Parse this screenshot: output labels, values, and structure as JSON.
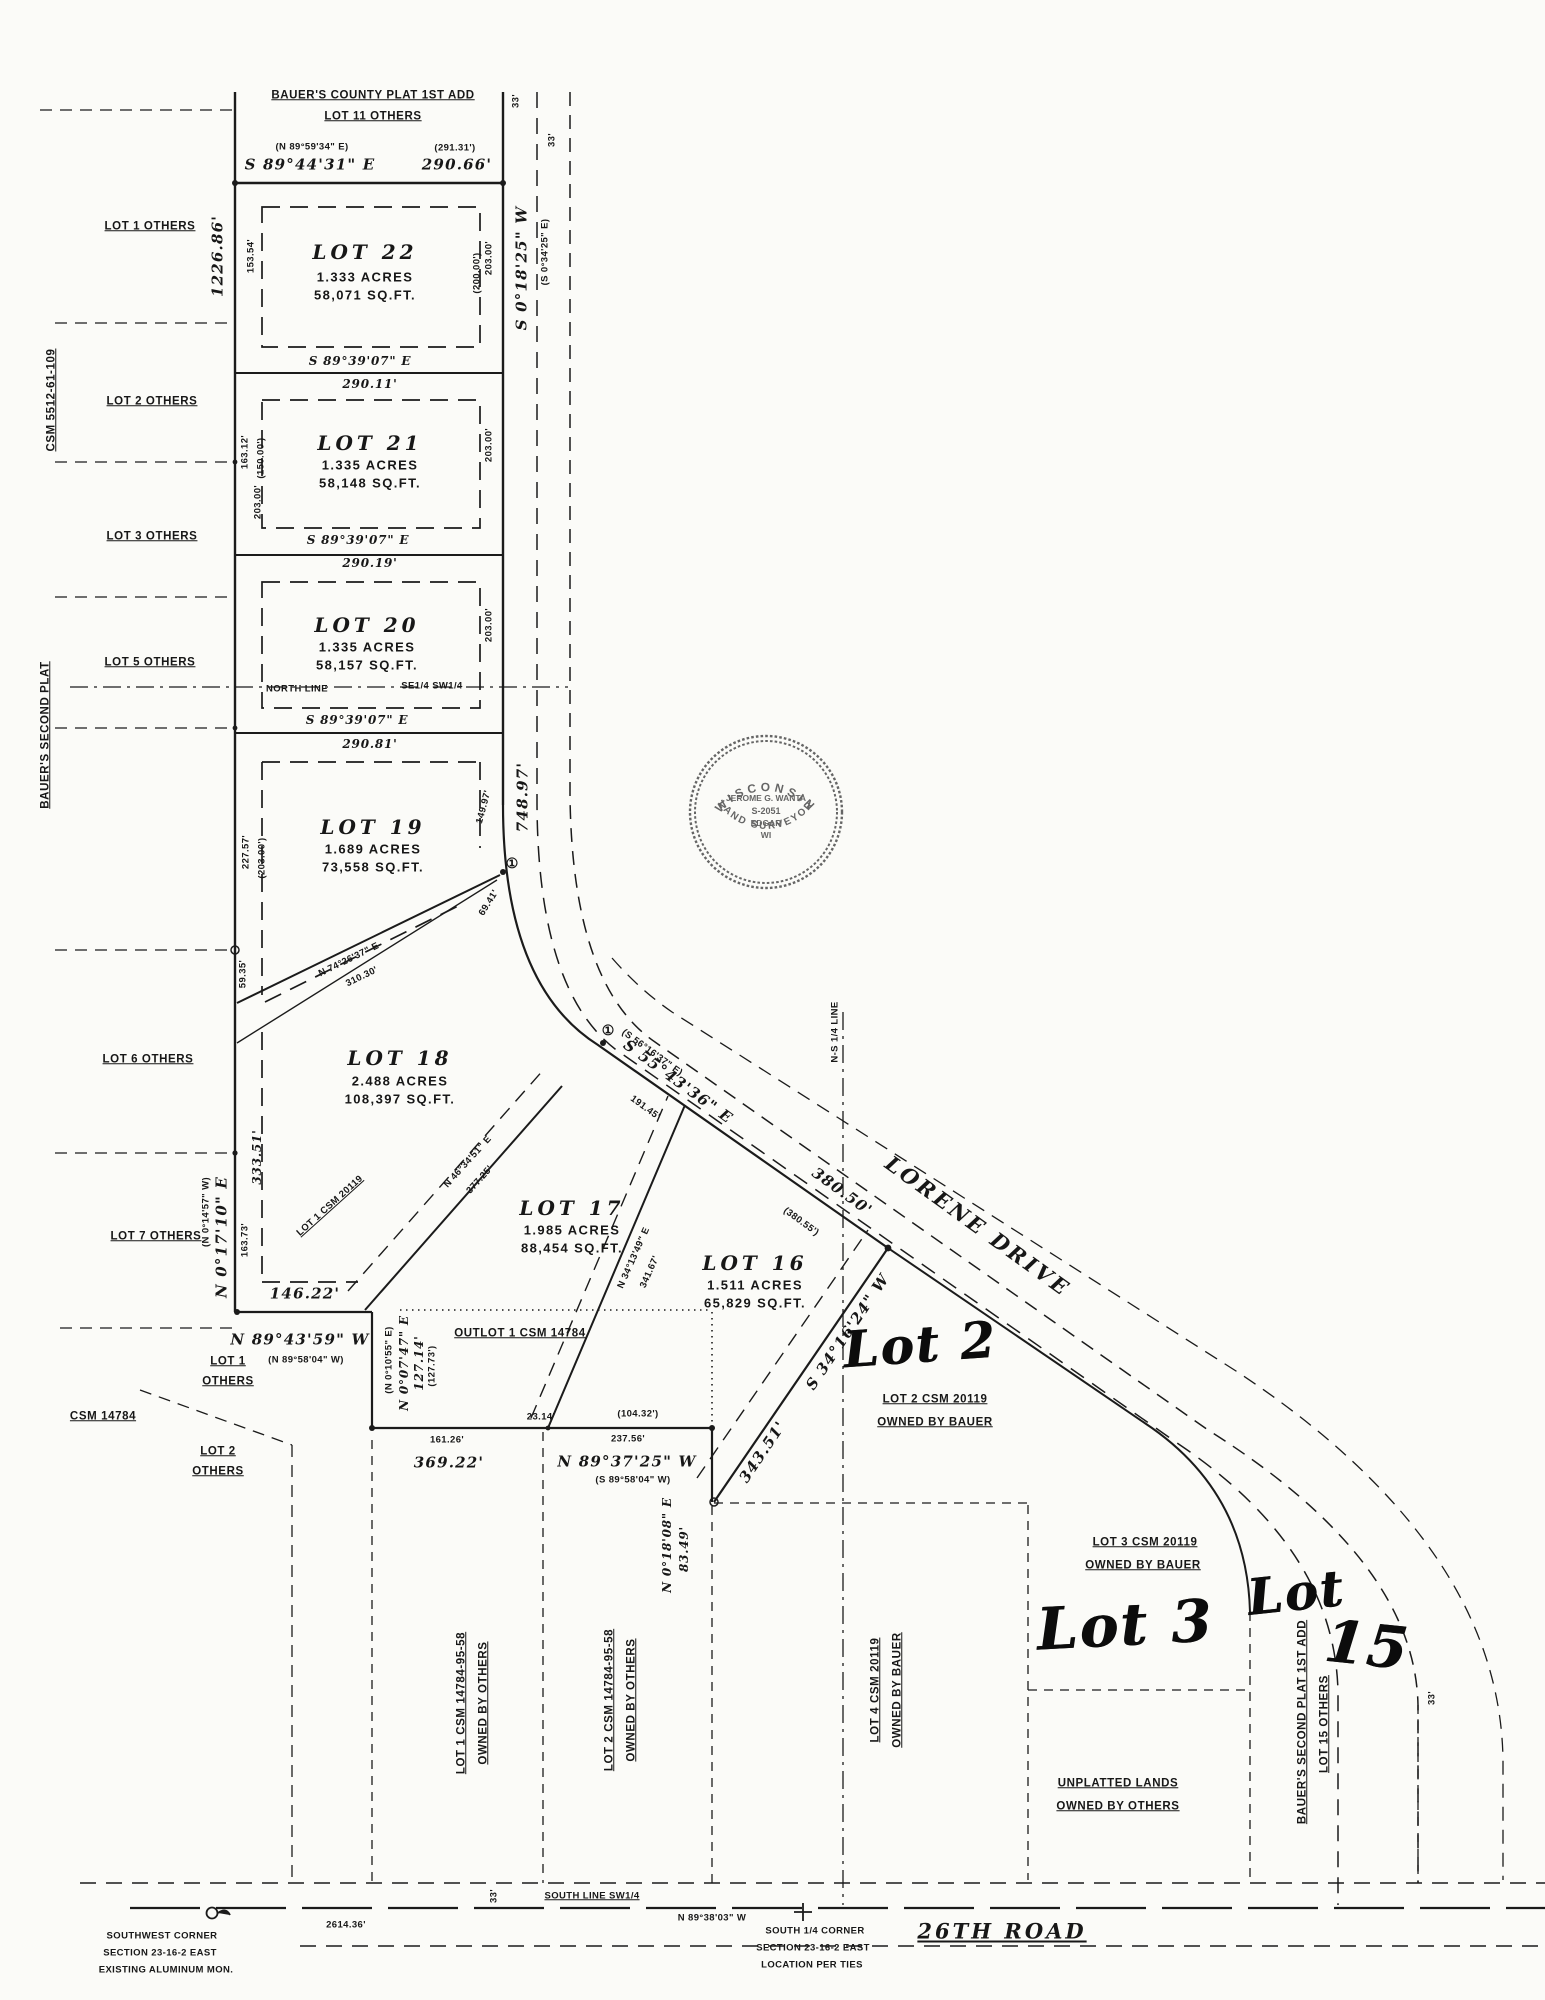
{
  "seal": {
    "arc_top": "WISCONSIN",
    "name": "JEROME G. WANTA",
    "number": "S-2051",
    "city": "EDGAR",
    "state": "WI",
    "arc_bottom": "LAND SURVEYOR"
  },
  "labels": [
    {
      "n": "plat-note-1",
      "t": "BAUER'S COUNTY PLAT 1ST ADD",
      "x": 373,
      "y": 96,
      "r": 0,
      "c": "sm u"
    },
    {
      "n": "plat-note-2",
      "t": "LOT 11 OTHERS",
      "x": 373,
      "y": 117,
      "r": 0,
      "c": "sm u"
    },
    {
      "n": "top-bearing-paren",
      "t": "(N 89°59'34\" E)",
      "x": 312,
      "y": 147,
      "r": 0,
      "c": "xs"
    },
    {
      "n": "top-dist-paren",
      "t": "(291.31')",
      "x": 455,
      "y": 148,
      "r": 0,
      "c": "xs"
    },
    {
      "n": "top-bearing",
      "t": "S 89°44'31\" E",
      "x": 310,
      "y": 165,
      "r": 0,
      "c": "dim"
    },
    {
      "n": "top-dist",
      "t": "290.66'",
      "x": 457,
      "y": 165,
      "r": 0,
      "c": "dim"
    },
    {
      "n": "row-width-33-a",
      "t": "33'",
      "x": 516,
      "y": 101,
      "r": -90,
      "c": "xs"
    },
    {
      "n": "row-width-33-b",
      "t": "33'",
      "x": 552,
      "y": 140,
      "r": -90,
      "c": "xs"
    },
    {
      "n": "west-line-dist",
      "t": "1226.86'",
      "x": 218,
      "y": 256,
      "r": -90,
      "c": "dim"
    },
    {
      "n": "road-bearing",
      "t": "S 0°18'25\" W",
      "x": 522,
      "y": 268,
      "r": -90,
      "c": "dim"
    },
    {
      "n": "road-bearing-paren",
      "t": "(S 0°34'25\" E)",
      "x": 545,
      "y": 252,
      "r": -90,
      "c": "xs"
    },
    {
      "n": "lot1-others",
      "t": "LOT 1 OTHERS",
      "x": 150,
      "y": 227,
      "r": 0,
      "c": "sm u"
    },
    {
      "n": "csm-5512",
      "t": "CSM 5512-61-109",
      "x": 52,
      "y": 400,
      "r": -90,
      "c": "sm u"
    },
    {
      "n": "lot2-others",
      "t": "LOT 2 OTHERS",
      "x": 152,
      "y": 402,
      "r": 0,
      "c": "sm u"
    },
    {
      "n": "lot3-others",
      "t": "LOT 3 OTHERS",
      "x": 152,
      "y": 537,
      "r": 0,
      "c": "sm u"
    },
    {
      "n": "lot5-others",
      "t": "LOT 5 OTHERS",
      "x": 150,
      "y": 663,
      "r": 0,
      "c": "sm u"
    },
    {
      "n": "bauers-second-left",
      "t": "BAUER'S SECOND PLAT",
      "x": 46,
      "y": 735,
      "r": -90,
      "c": "sm u"
    },
    {
      "n": "lot6-others",
      "t": "LOT 6 OTHERS",
      "x": 148,
      "y": 1060,
      "r": 0,
      "c": "sm u"
    },
    {
      "n": "lot7-others",
      "t": "LOT 7 OTHERS",
      "x": 156,
      "y": 1237,
      "r": 0,
      "c": "sm u"
    },
    {
      "n": "lot22-title",
      "t": "LOT 22",
      "x": 365,
      "y": 252,
      "r": 0,
      "c": "lt"
    },
    {
      "n": "lot22-acres",
      "t": "1.333 ACRES",
      "x": 365,
      "y": 277,
      "r": 0,
      "c": "ls"
    },
    {
      "n": "lot22-sqft",
      "t": "58,071 SQ.FT.",
      "x": 365,
      "y": 295,
      "r": 0,
      "c": "ls"
    },
    {
      "n": "lot21-title",
      "t": "LOT 21",
      "x": 370,
      "y": 443,
      "r": 0,
      "c": "lt"
    },
    {
      "n": "lot21-acres",
      "t": "1.335 ACRES",
      "x": 370,
      "y": 465,
      "r": 0,
      "c": "ls"
    },
    {
      "n": "lot21-sqft",
      "t": "58,148 SQ.FT.",
      "x": 370,
      "y": 483,
      "r": 0,
      "c": "ls"
    },
    {
      "n": "lot20-title",
      "t": "LOT 20",
      "x": 367,
      "y": 625,
      "r": 0,
      "c": "lt"
    },
    {
      "n": "lot20-acres",
      "t": "1.335 ACRES",
      "x": 367,
      "y": 647,
      "r": 0,
      "c": "ls"
    },
    {
      "n": "lot20-sqft",
      "t": "58,157 SQ.FT.",
      "x": 367,
      "y": 665,
      "r": 0,
      "c": "ls"
    },
    {
      "n": "lot19-title",
      "t": "LOT 19",
      "x": 373,
      "y": 827,
      "r": 0,
      "c": "lt"
    },
    {
      "n": "lot19-acres",
      "t": "1.689 ACRES",
      "x": 373,
      "y": 849,
      "r": 0,
      "c": "ls"
    },
    {
      "n": "lot19-sqft",
      "t": "73,558 SQ.FT.",
      "x": 373,
      "y": 867,
      "r": 0,
      "c": "ls"
    },
    {
      "n": "lot18-title",
      "t": "LOT 18",
      "x": 400,
      "y": 1058,
      "r": 0,
      "c": "lt"
    },
    {
      "n": "lot18-acres",
      "t": "2.488 ACRES",
      "x": 400,
      "y": 1081,
      "r": 0,
      "c": "ls"
    },
    {
      "n": "lot18-sqft",
      "t": "108,397 SQ.FT.",
      "x": 400,
      "y": 1099,
      "r": 0,
      "c": "ls"
    },
    {
      "n": "lot17-title",
      "t": "LOT 17",
      "x": 572,
      "y": 1208,
      "r": 0,
      "c": "lt"
    },
    {
      "n": "lot17-acres",
      "t": "1.985 ACRES",
      "x": 572,
      "y": 1230,
      "r": 0,
      "c": "ls"
    },
    {
      "n": "lot17-sqft",
      "t": "88,454 SQ.FT.",
      "x": 572,
      "y": 1248,
      "r": 0,
      "c": "ls"
    },
    {
      "n": "lot16-title",
      "t": "LOT 16",
      "x": 755,
      "y": 1263,
      "r": 0,
      "c": "lt"
    },
    {
      "n": "lot16-acres",
      "t": "1.511 ACRES",
      "x": 755,
      "y": 1285,
      "r": 0,
      "c": "ls"
    },
    {
      "n": "lot16-sqft",
      "t": "65,829 SQ.FT.",
      "x": 755,
      "y": 1303,
      "r": 0,
      "c": "ls"
    },
    {
      "n": "lot22-dim-left",
      "t": "153.54'",
      "x": 251,
      "y": 256,
      "r": -90,
      "c": "xs"
    },
    {
      "n": "lot22-dim-right",
      "t": "203.00'",
      "x": 489,
      "y": 258,
      "r": -90,
      "c": "xs"
    },
    {
      "n": "lot22-dim-right-paren",
      "t": "(200.00')",
      "x": 477,
      "y": 273,
      "r": -90,
      "c": "xs"
    },
    {
      "n": "lot21-dim-left",
      "t": "163.12'",
      "x": 245,
      "y": 452,
      "r": -90,
      "c": "xs"
    },
    {
      "n": "lot21-dim-left-paren",
      "t": "(150.00')",
      "x": 261,
      "y": 458,
      "r": -90,
      "c": "xs"
    },
    {
      "n": "lot21-dim-right",
      "t": "203.00'",
      "x": 489,
      "y": 445,
      "r": -90,
      "c": "xs"
    },
    {
      "n": "lot20-dim-left",
      "t": "203.00'",
      "x": 258,
      "y": 502,
      "r": -90,
      "c": "xs"
    },
    {
      "n": "lot20-dim-right",
      "t": "203.00'",
      "x": 489,
      "y": 625,
      "r": -90,
      "c": "xs"
    },
    {
      "n": "lot19-dim-left",
      "t": "227.57'",
      "x": 246,
      "y": 852,
      "r": -90,
      "c": "xs"
    },
    {
      "n": "lot19-dim-left-paren",
      "t": "(203.00')",
      "x": 262,
      "y": 858,
      "r": -90,
      "c": "xs"
    },
    {
      "n": "lot19-dim-right",
      "t": "149.97'",
      "x": 484,
      "y": 807,
      "r": -75,
      "c": "xs"
    },
    {
      "n": "lot19-dim-right2",
      "t": "69.41'",
      "x": 489,
      "y": 903,
      "r": -58,
      "c": "xs"
    },
    {
      "n": "lot18-dim-topleft",
      "t": "59.35'",
      "x": 243,
      "y": 974,
      "r": -90,
      "c": "xs"
    },
    {
      "n": "lot18-dim-left",
      "t": "333.51'",
      "x": 257,
      "y": 1157,
      "r": -90,
      "c": "dimsm"
    },
    {
      "n": "lot18-dim-left2",
      "t": "163.73'",
      "x": 245,
      "y": 1240,
      "r": -90,
      "c": "xs"
    },
    {
      "n": "div1-bearing",
      "t": "S 89°39'07\" E",
      "x": 360,
      "y": 361,
      "r": 0,
      "c": "dimsm"
    },
    {
      "n": "div1-dist",
      "t": "290.11'",
      "x": 370,
      "y": 384,
      "r": 0,
      "c": "dimsm"
    },
    {
      "n": "div2-bearing",
      "t": "S 89°39'07\" E",
      "x": 358,
      "y": 540,
      "r": 0,
      "c": "dimsm"
    },
    {
      "n": "div2-dist",
      "t": "290.19'",
      "x": 370,
      "y": 563,
      "r": 0,
      "c": "dimsm"
    },
    {
      "n": "div3-bearing",
      "t": "S 89°39'07\" E",
      "x": 357,
      "y": 720,
      "r": 0,
      "c": "dimsm"
    },
    {
      "n": "div3-dist",
      "t": "290.81'",
      "x": 370,
      "y": 744,
      "r": 0,
      "c": "dimsm"
    },
    {
      "n": "north-line",
      "t": "NORTH LINE",
      "x": 297,
      "y": 689,
      "r": 0,
      "c": "xs"
    },
    {
      "n": "se-sw-quarter",
      "t": "SE1/4 SW1/4",
      "x": 432,
      "y": 686,
      "r": 0,
      "c": "xs"
    },
    {
      "n": "road-dist",
      "t": "748.97'",
      "x": 523,
      "y": 797,
      "r": -90,
      "c": "dim"
    },
    {
      "n": "lot19-diag-bearing",
      "t": "N 74°26'37\" E",
      "x": 349,
      "y": 960,
      "r": -26,
      "c": "xs"
    },
    {
      "n": "lot19-diag-dist",
      "t": "310.30'",
      "x": 362,
      "y": 977,
      "r": -26,
      "c": "xs"
    },
    {
      "n": "curve-marker-1",
      "t": "①",
      "x": 512,
      "y": 863,
      "r": 0,
      "c": "cm"
    },
    {
      "n": "curve-marker-2",
      "t": "①",
      "x": 608,
      "y": 1030,
      "r": 0,
      "c": "cm"
    },
    {
      "n": "west-bearing",
      "t": "N 0°17'10\" E",
      "x": 222,
      "y": 1237,
      "r": -90,
      "c": "dim"
    },
    {
      "n": "west-bearing-paren",
      "t": "(N 0°14'57\" W)",
      "x": 206,
      "y": 1212,
      "r": -90,
      "c": "xs"
    },
    {
      "n": "lot18-s-dist",
      "t": "146.22'",
      "x": 305,
      "y": 1294,
      "r": 0,
      "c": "dim"
    },
    {
      "n": "lot18-s-bearing",
      "t": "N 89°43'59\" W",
      "x": 300,
      "y": 1340,
      "r": 0,
      "c": "dim"
    },
    {
      "n": "lot18-s-paren",
      "t": "(N 89°58'04\" W)",
      "x": 306,
      "y": 1360,
      "r": 0,
      "c": "xs"
    },
    {
      "n": "csm20119-hatch",
      "t": "LOT 1 CSM 20119",
      "x": 330,
      "y": 1206,
      "r": -42,
      "c": "xs u"
    },
    {
      "n": "lot17-diag-bearing",
      "t": "N 46°34'51\" E",
      "x": 468,
      "y": 1162,
      "r": -48,
      "c": "xs"
    },
    {
      "n": "lot17-diag-dist",
      "t": "377.25'",
      "x": 480,
      "y": 1180,
      "r": -48,
      "c": "xs"
    },
    {
      "n": "lot16-diag-bearing",
      "t": "N 34°13'49\" E",
      "x": 634,
      "y": 1258,
      "r": -66,
      "c": "xs"
    },
    {
      "n": "lot16-diag-dist",
      "t": "341.67'",
      "x": 650,
      "y": 1272,
      "r": -66,
      "c": "xs"
    },
    {
      "n": "lorene-bearing-paren",
      "t": "(S 56°16'37\" E)",
      "x": 652,
      "y": 1053,
      "r": 36,
      "c": "xs"
    },
    {
      "n": "lorene-bearing",
      "t": "S 55°43'36\" E",
      "x": 678,
      "y": 1082,
      "r": 36,
      "c": "dim"
    },
    {
      "n": "lorene-dist-1",
      "t": "191.45'",
      "x": 645,
      "y": 1108,
      "r": 36,
      "c": "xs"
    },
    {
      "n": "lorene-dist-2",
      "t": "380.50'",
      "x": 842,
      "y": 1192,
      "r": 36,
      "c": "dim"
    },
    {
      "n": "lorene-dist-2-paren",
      "t": "(380.55')",
      "x": 801,
      "y": 1222,
      "r": 36,
      "c": "xs"
    },
    {
      "n": "lorene-drive-name",
      "t": "LORENE DRIVE",
      "x": 978,
      "y": 1226,
      "r": 36,
      "c": "road"
    },
    {
      "n": "ns-quarter-line",
      "t": "N-S 1/4 LINE",
      "x": 835,
      "y": 1032,
      "r": -90,
      "c": "xs"
    },
    {
      "n": "lot2-diag-bearing",
      "t": "S 34°16'24\" W",
      "x": 848,
      "y": 1332,
      "r": -56,
      "c": "dim"
    },
    {
      "n": "lot2-diag-dist",
      "t": "343.51'",
      "x": 763,
      "y": 1452,
      "r": -56,
      "c": "dim"
    },
    {
      "n": "outlot-label",
      "t": "OUTLOT 1 CSM 14784",
      "x": 520,
      "y": 1334,
      "r": 0,
      "c": "sm u"
    },
    {
      "n": "outlot-w-paren",
      "t": "(N 0°10'55\" E)",
      "x": 389,
      "y": 1360,
      "r": -90,
      "c": "xs"
    },
    {
      "n": "outlot-w-bearing",
      "t": "N 0°07'47\" E",
      "x": 404,
      "y": 1363,
      "r": -90,
      "c": "dimsm"
    },
    {
      "n": "outlot-w-dist",
      "t": "127.14'",
      "x": 419,
      "y": 1363,
      "r": -90,
      "c": "dimsm"
    },
    {
      "n": "outlot-w-dist-paren",
      "t": "(127.73')",
      "x": 432,
      "y": 1366,
      "r": -90,
      "c": "xs"
    },
    {
      "n": "south-dist-1",
      "t": "161.26'",
      "x": 447,
      "y": 1440,
      "r": 0,
      "c": "xs"
    },
    {
      "n": "south-dist-1b",
      "t": "369.22'",
      "x": 449,
      "y": 1463,
      "r": 0,
      "c": "dim"
    },
    {
      "n": "south-dist-tick",
      "t": "23.14'",
      "x": 541,
      "y": 1417,
      "r": 0,
      "c": "xs"
    },
    {
      "n": "south-dist-paren",
      "t": "(104.32')",
      "x": 638,
      "y": 1414,
      "r": 0,
      "c": "xs"
    },
    {
      "n": "south-dist-2",
      "t": "237.56'",
      "x": 628,
      "y": 1439,
      "r": 0,
      "c": "xs"
    },
    {
      "n": "south-bearing",
      "t": "N 89°37'25\" W",
      "x": 627,
      "y": 1462,
      "r": 0,
      "c": "dim"
    },
    {
      "n": "south-bearing-paren",
      "t": "(S 89°58'04\" W)",
      "x": 633,
      "y": 1480,
      "r": 0,
      "c": "xs"
    },
    {
      "n": "east-jog-bearing",
      "t": "N 0°18'08\" E",
      "x": 667,
      "y": 1545,
      "r": -90,
      "c": "dimsm"
    },
    {
      "n": "east-jog-dist",
      "t": "83.49'",
      "x": 684,
      "y": 1549,
      "r": -90,
      "c": "dimsm"
    },
    {
      "n": "handwritten-lot2",
      "t": "Lot 2",
      "x": 920,
      "y": 1345,
      "r": -4,
      "c": "hand"
    },
    {
      "n": "handwritten-lot3",
      "t": "Lot 3",
      "x": 1125,
      "y": 1625,
      "r": -3,
      "c": "hand hand2"
    },
    {
      "n": "handwritten-lot15-a",
      "t": "Lot",
      "x": 1296,
      "y": 1593,
      "r": -6,
      "c": "hand"
    },
    {
      "n": "handwritten-lot15-b",
      "t": "15",
      "x": 1367,
      "y": 1645,
      "r": 6,
      "c": "hand hand2"
    },
    {
      "n": "lot2-csm-1",
      "t": "LOT 2 CSM 20119",
      "x": 935,
      "y": 1400,
      "r": 0,
      "c": "sm u"
    },
    {
      "n": "lot2-csm-2",
      "t": "OWNED BY BAUER",
      "x": 935,
      "y": 1423,
      "r": 0,
      "c": "sm u"
    },
    {
      "n": "lot3-csm-1",
      "t": "LOT 3 CSM 20119",
      "x": 1145,
      "y": 1543,
      "r": 0,
      "c": "sm u"
    },
    {
      "n": "lot3-csm-2",
      "t": "OWNED BY BAUER",
      "x": 1143,
      "y": 1566,
      "r": 0,
      "c": "sm u"
    },
    {
      "n": "unplatted-1",
      "t": "UNPLATTED LANDS",
      "x": 1118,
      "y": 1784,
      "r": 0,
      "c": "sm u"
    },
    {
      "n": "unplatted-2",
      "t": "OWNED BY OTHERS",
      "x": 1118,
      "y": 1807,
      "r": 0,
      "c": "sm u"
    },
    {
      "n": "parcel1-rot-1",
      "t": "LOT 1 CSM 14784-95-58",
      "x": 462,
      "y": 1703,
      "r": -90,
      "c": "sm u"
    },
    {
      "n": "parcel1-rot-2",
      "t": "OWNED BY OTHERS",
      "x": 484,
      "y": 1703,
      "r": -90,
      "c": "sm u"
    },
    {
      "n": "parcel2-rot-1",
      "t": "LOT 2 CSM 14784-95-58",
      "x": 610,
      "y": 1700,
      "r": -90,
      "c": "sm u"
    },
    {
      "n": "parcel2-rot-2",
      "t": "OWNED BY OTHERS",
      "x": 632,
      "y": 1700,
      "r": -90,
      "c": "sm u"
    },
    {
      "n": "parcel4-rot-1",
      "t": "LOT 4 CSM 20119",
      "x": 876,
      "y": 1690,
      "r": -90,
      "c": "sm u"
    },
    {
      "n": "parcel4-rot-2",
      "t": "OWNED BY BAUER",
      "x": 898,
      "y": 1690,
      "r": -90,
      "c": "sm u"
    },
    {
      "n": "lot15-plat-rot-1",
      "t": "BAUER'S SECOND PLAT 1ST ADD",
      "x": 1303,
      "y": 1722,
      "r": -90,
      "c": "sm u"
    },
    {
      "n": "lot15-plat-rot-2",
      "t": "LOT 15 OTHERS",
      "x": 1325,
      "y": 1724,
      "r": -90,
      "c": "sm u"
    },
    {
      "n": "bl-lot1-a",
      "t": "LOT 1",
      "x": 228,
      "y": 1362,
      "r": 0,
      "c": "sm u"
    },
    {
      "n": "bl-lot1-b",
      "t": "OTHERS",
      "x": 228,
      "y": 1382,
      "r": 0,
      "c": "sm u"
    },
    {
      "n": "bl-csm14784",
      "t": "CSM 14784",
      "x": 103,
      "y": 1417,
      "r": 0,
      "c": "sm u"
    },
    {
      "n": "bl-lot2-a",
      "t": "LOT 2",
      "x": 218,
      "y": 1452,
      "r": 0,
      "c": "sm u"
    },
    {
      "n": "bl-lot2-b",
      "t": "OTHERS",
      "x": 218,
      "y": 1472,
      "r": 0,
      "c": "sm u"
    },
    {
      "n": "south-line-sw",
      "t": "SOUTH LINE SW1/4",
      "x": 592,
      "y": 1896,
      "r": 0,
      "c": "xs u"
    },
    {
      "n": "bottom-33",
      "t": "33'",
      "x": 494,
      "y": 1896,
      "r": -90,
      "c": "xs"
    },
    {
      "n": "bottom-2614",
      "t": "2614.36'",
      "x": 346,
      "y": 1925,
      "r": 0,
      "c": "xs"
    },
    {
      "n": "sw-corner-1",
      "t": "SOUTHWEST CORNER",
      "x": 162,
      "y": 1936,
      "r": 0,
      "c": "xs"
    },
    {
      "n": "sw-corner-2",
      "t": "SECTION 23-16-2 EAST",
      "x": 160,
      "y": 1953,
      "r": 0,
      "c": "xs"
    },
    {
      "n": "sw-corner-3",
      "t": "EXISTING ALUMINUM MON.",
      "x": 166,
      "y": 1970,
      "r": 0,
      "c": "xs"
    },
    {
      "n": "bottom-bearing",
      "t": "N 89°38'03\" W",
      "x": 712,
      "y": 1918,
      "r": 0,
      "c": "xs"
    },
    {
      "n": "s-quarter-1",
      "t": "SOUTH 1/4 CORNER",
      "x": 815,
      "y": 1931,
      "r": 0,
      "c": "xs"
    },
    {
      "n": "s-quarter-2",
      "t": "SECTION 23-16-2 EAST",
      "x": 813,
      "y": 1948,
      "r": 0,
      "c": "xs"
    },
    {
      "n": "s-quarter-3",
      "t": "LOCATION PER TIES",
      "x": 812,
      "y": 1965,
      "r": 0,
      "c": "xs"
    },
    {
      "n": "road-26th",
      "t": "26TH ROAD",
      "x": 1002,
      "y": 1931,
      "r": 0,
      "c": "road u"
    },
    {
      "n": "right-33",
      "t": "33'",
      "x": 1432,
      "y": 1698,
      "r": -90,
      "c": "xs"
    }
  ]
}
